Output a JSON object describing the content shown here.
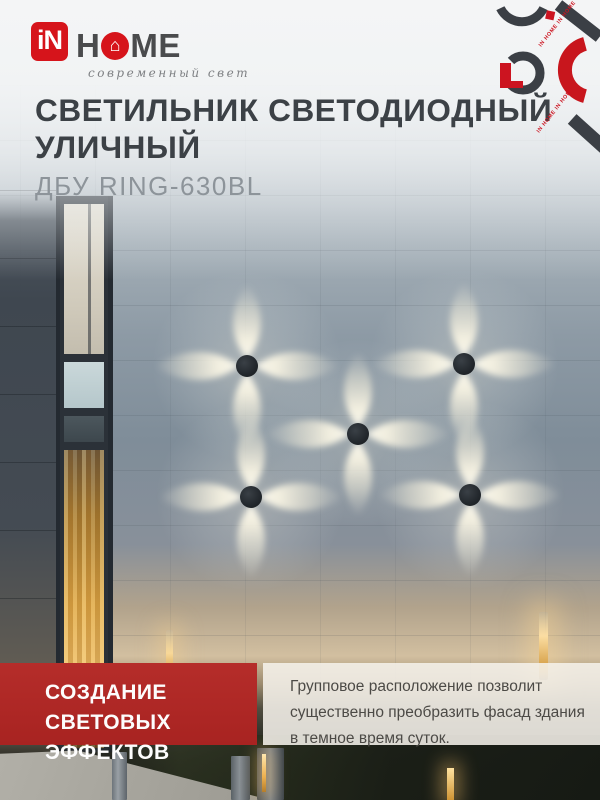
{
  "brand": {
    "logo_in": "iN",
    "logo_h": "H",
    "logo_me": "ME",
    "house_glyph": "⌂",
    "tagline": "современный свет",
    "watermark": "IN HOME IN HOME"
  },
  "header": {
    "title_line1": "СВЕТИЛЬНИК СВЕТОДИОДНЫЙ",
    "title_line2": "УЛИЧНЫЙ",
    "model": "ДБУ RING-630BL"
  },
  "feature": {
    "banner_line1": "СОЗДАНИЕ СВЕТОВЫХ",
    "banner_line2": "ЭФФЕКТОВ",
    "desc_line1": "Групповое расположение позволит",
    "desc_line2": "существенно преобразить фасад здания",
    "desc_line3": "в темное время суток."
  },
  "photo": {
    "subject": "фасад здания с пятью настенными светильниками",
    "fixtures_count": "5"
  },
  "colors": {
    "brand_red": "#d6141b",
    "banner_red": "#b02a28",
    "decor_red": "#cc1420",
    "decor_dark": "#3b3f45",
    "title_dark": "#3c4146",
    "model_gray": "#8d949a"
  }
}
